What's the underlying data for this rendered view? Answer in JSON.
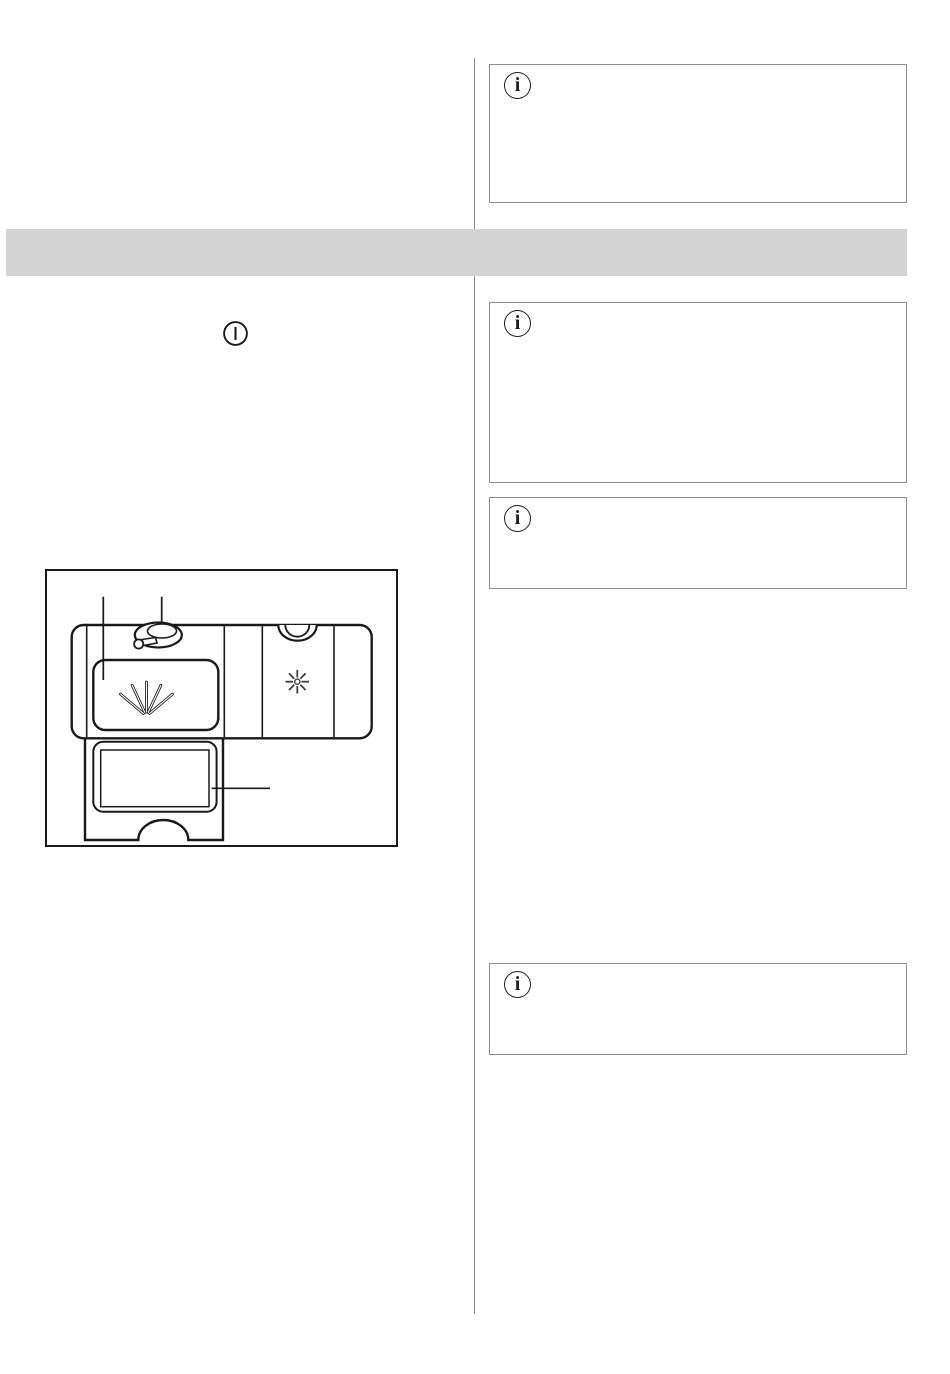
{
  "page": {
    "kind": "appliance-manual-page",
    "background": "#ffffff",
    "divider_color": "#8a8a8a"
  },
  "section_header_band": {
    "label": "",
    "background": "#d3d3d3"
  },
  "icons": {
    "info_glyph": "i",
    "power_on": "circled-vertical-bar",
    "rinse_aid_fan": "fan-spray-symbol",
    "rinse_aid_star": "eight-ray-star-symbol"
  },
  "info_boxes": [
    {
      "id": "top-right",
      "icon": "info-icon",
      "text": ""
    },
    {
      "id": "right-upper",
      "icon": "info-icon",
      "text": ""
    },
    {
      "id": "right-middle",
      "icon": "info-icon",
      "text": ""
    },
    {
      "id": "right-lower",
      "icon": "info-icon",
      "text": ""
    }
  ],
  "left_column": {
    "power_symbol": {
      "icon": "power-on-icon"
    },
    "diagram": {
      "name": "detergent-dispenser-diagram",
      "caption": "",
      "parts": [
        "rinse-aid-lid-with-fan-symbol",
        "rinse-aid-cap-with-latch",
        "refill-indicator-star",
        "detergent-compartment"
      ],
      "callout_lines": 3
    }
  },
  "colors": {
    "line": "#1a1a1a",
    "box_border": "#8f8f8f",
    "band": "#d3d3d3"
  }
}
